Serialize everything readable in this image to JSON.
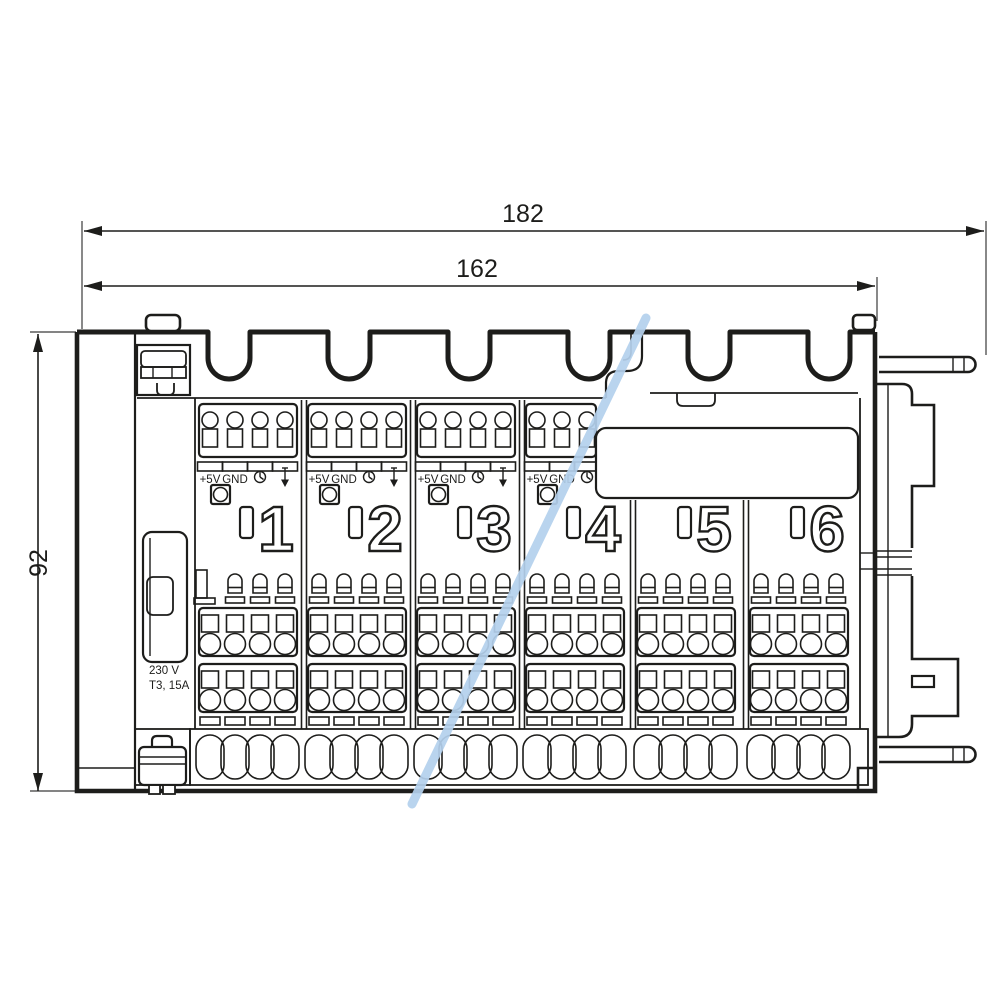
{
  "dimensions": {
    "width_outer": "182",
    "width_inner": "162",
    "height": "92"
  },
  "power_label": {
    "line1": "230 V",
    "line2": "T3, 15A"
  },
  "terminal_labels": {
    "supply": "+5V",
    "ground": "GND"
  },
  "zones": [
    "1",
    "2",
    "3",
    "4",
    "5",
    "6"
  ],
  "icons": {
    "timer": "clock-icon",
    "output_direction": "arrow-down-icon"
  },
  "colors": {
    "ink": "#1d1d1b",
    "highlight": "#b4d1ed",
    "paper": "#ffffff"
  }
}
